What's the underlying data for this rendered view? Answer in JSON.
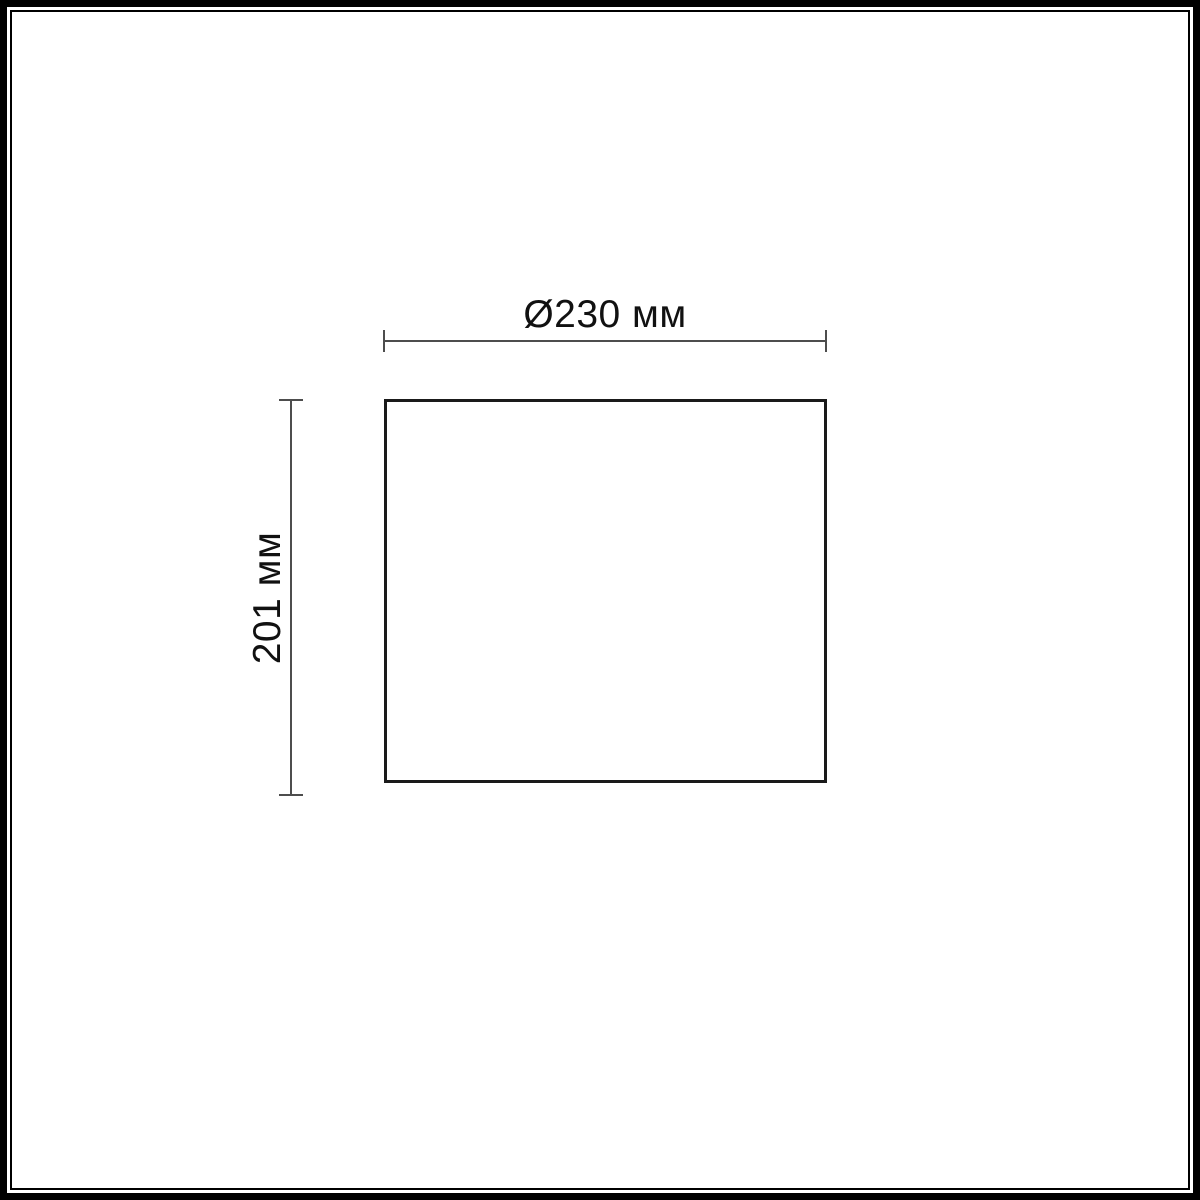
{
  "diagram": {
    "type": "product-dimension-drawing",
    "shape": "rectangle",
    "width_label": "Ø230 мм",
    "height_label": "201 мм",
    "width_value_mm": 230,
    "height_value_mm": 201
  },
  "colors": {
    "frame": "#000000",
    "shape_border": "#1a1a1a",
    "dimension_line": "#4d4d4d",
    "text": "#111111",
    "background": "#ffffff"
  }
}
